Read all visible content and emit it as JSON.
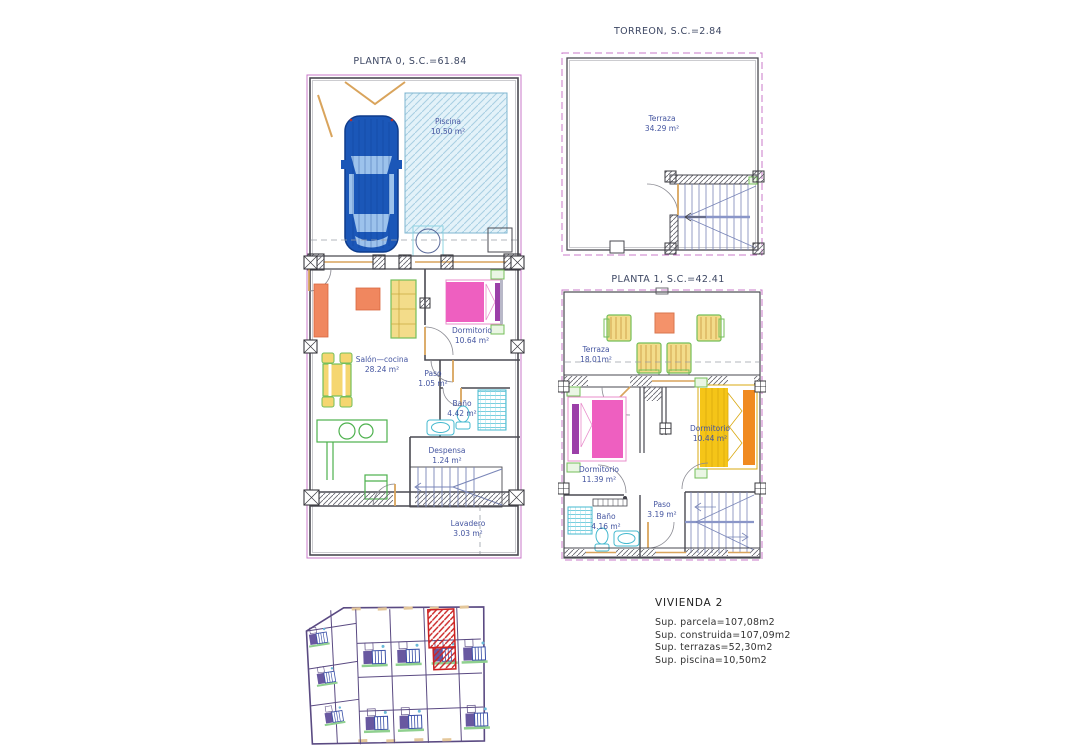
{
  "plans": {
    "planta0": {
      "title": "PLANTA 0, S.C.=61.84",
      "rooms": {
        "piscina": {
          "name": "Piscina",
          "area": "10.50 m²"
        },
        "salon": {
          "name": "Salón—cocina",
          "area": "28.24 m²"
        },
        "dormitorio": {
          "name": "Dormitorio",
          "area": "10.64 m²"
        },
        "paso": {
          "name": "Paso",
          "area": "1.05 m²"
        },
        "bano": {
          "name": "Baño",
          "area": "4.42 m²"
        },
        "despensa": {
          "name": "Despensa",
          "area": "1.24 m²"
        },
        "lavadero": {
          "name": "Lavadero",
          "area": "3.03 m²"
        }
      }
    },
    "torreon": {
      "title": "TORREON, S.C.=2.84",
      "rooms": {
        "terraza": {
          "name": "Terraza",
          "area": "34.29 m²"
        }
      }
    },
    "planta1": {
      "title": "PLANTA 1, S.C.=42.41",
      "rooms": {
        "terraza": {
          "name": "Terraza",
          "area": "18.01m²"
        },
        "dormitorio_izq": {
          "name": "Dormitorio",
          "area": "11.39 m²"
        },
        "dormitorio_der": {
          "name": "Dormitorio",
          "area": "10.44 m²"
        },
        "paso": {
          "name": "Paso",
          "area": "3.19 m²"
        },
        "bano": {
          "name": "Baño",
          "area": "4.16 m²"
        }
      }
    }
  },
  "summary": {
    "title": "VIVIENDA 2",
    "lines": [
      "Sup.  parcela=107,08m2",
      "Sup.  construida=107,09m2",
      "Sup.  terrazas=52,30m2",
      "Sup.  piscina=10,50m2"
    ]
  },
  "palette": {
    "boundary_magenta": "#c878c8",
    "wall_dark": "#4a4a52",
    "carpentry_orange": "#d9a45c",
    "label_navy": "#4455a0",
    "stair_blue": "#7a86b8",
    "fixture_cyan": "#45b9cf",
    "furniture_green": "#5cb84c",
    "bed_pink": "#ee5fc0",
    "bed_purple": "#9b3fa8",
    "bed_yellow": "#f5c518",
    "bed_orange": "#f08a20",
    "sofa_yellow": "#f3dc8a",
    "table_peach": "#f4926a",
    "pool_blue": "#e3f2f9",
    "car_blue": "#1b57b8",
    "site_wall_purple": "#5a4a82",
    "highlight_red": "#cc2222"
  }
}
